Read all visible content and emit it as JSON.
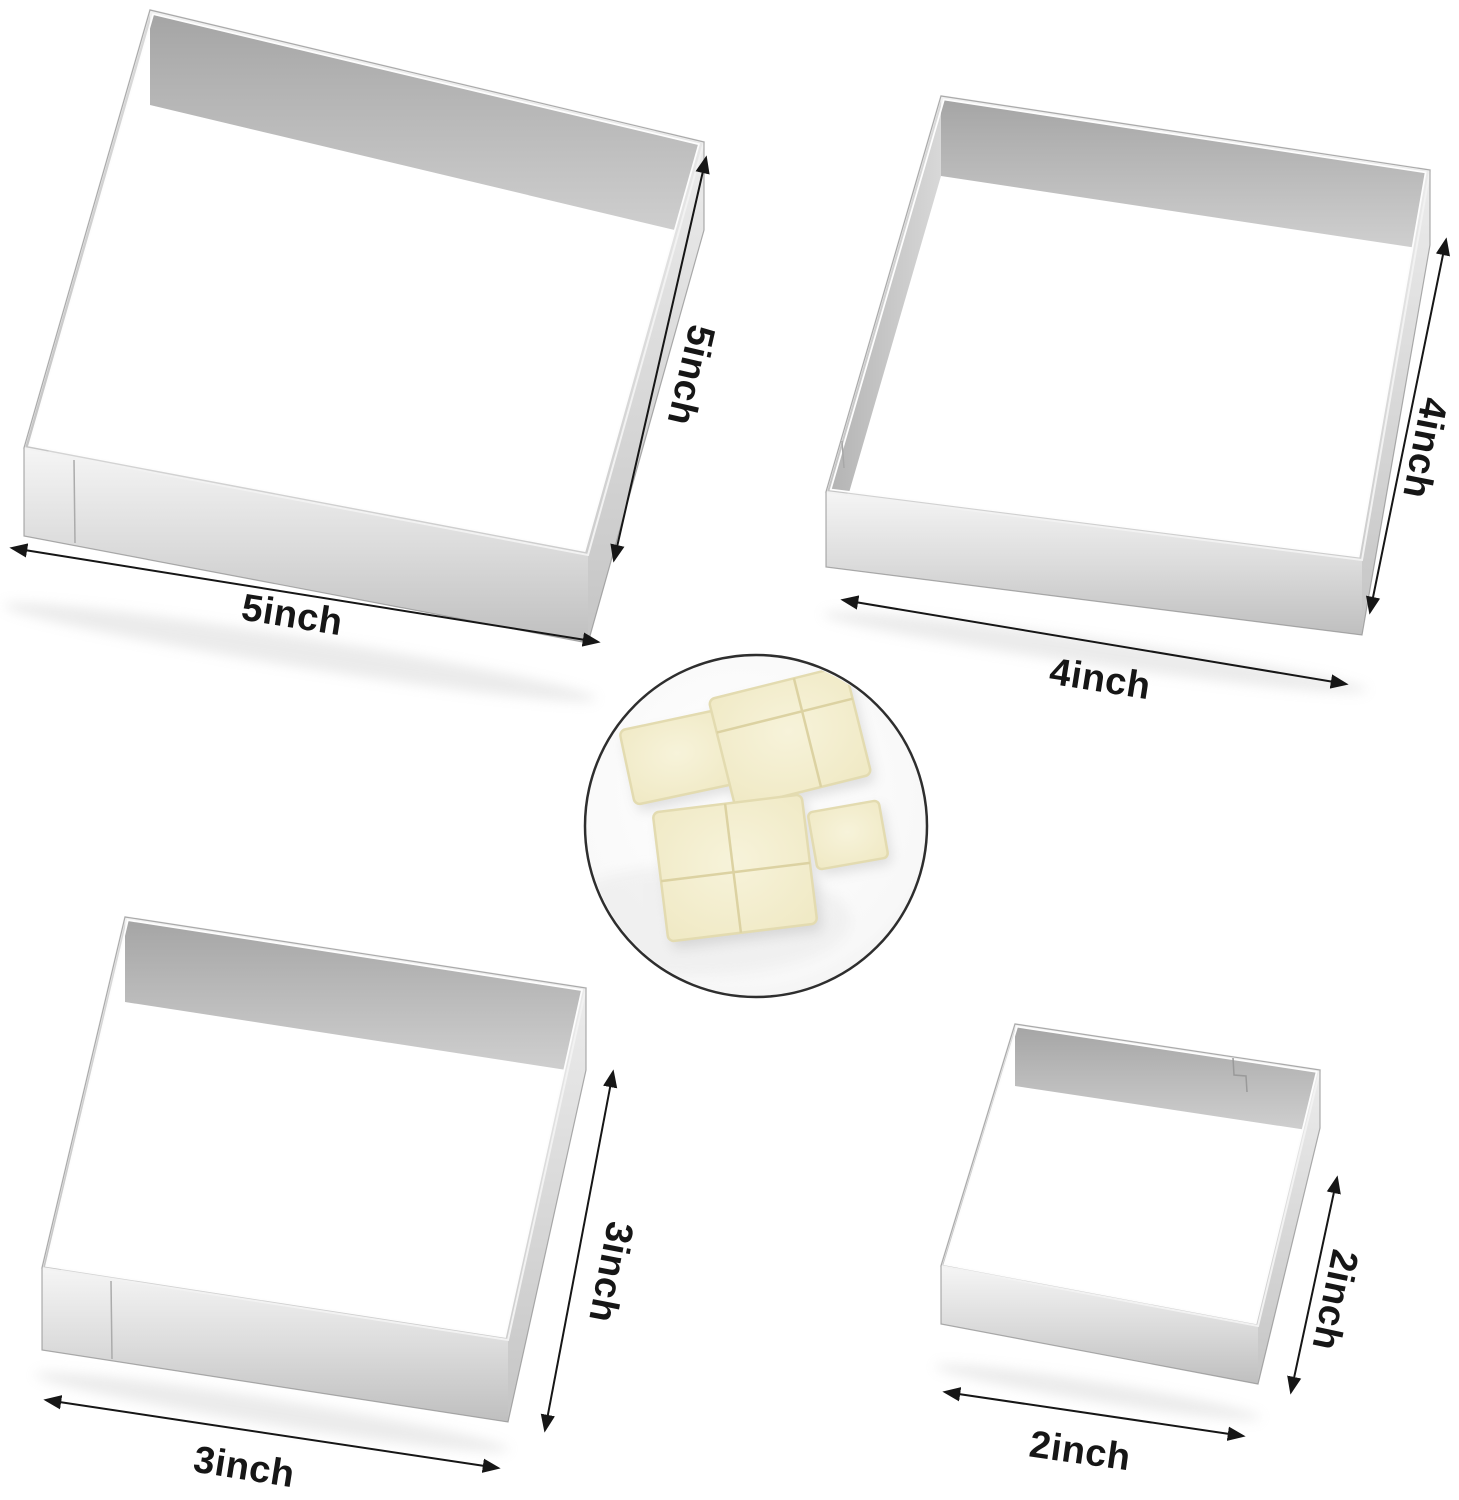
{
  "molds": [
    {
      "id": "mold-5inch",
      "size_label": "5inch"
    },
    {
      "id": "mold-4inch",
      "size_label": "4inch"
    },
    {
      "id": "mold-3inch",
      "size_label": "3inch"
    },
    {
      "id": "mold-2inch",
      "size_label": "2inch"
    }
  ],
  "inset": {
    "bread_piece_count": 4
  },
  "colors": {
    "background": "#ffffff",
    "metal_light": "#f1f1f1",
    "metal_mid": "#cccccc",
    "metal_dark": "#a5a5a5",
    "annotation_text": "#161616",
    "arrow": "#161616",
    "bread": "#f2edcb",
    "bread_crust": "#e3dbb0",
    "plate": "#f8f8f8",
    "plate_outline": "#2e2e2e"
  }
}
